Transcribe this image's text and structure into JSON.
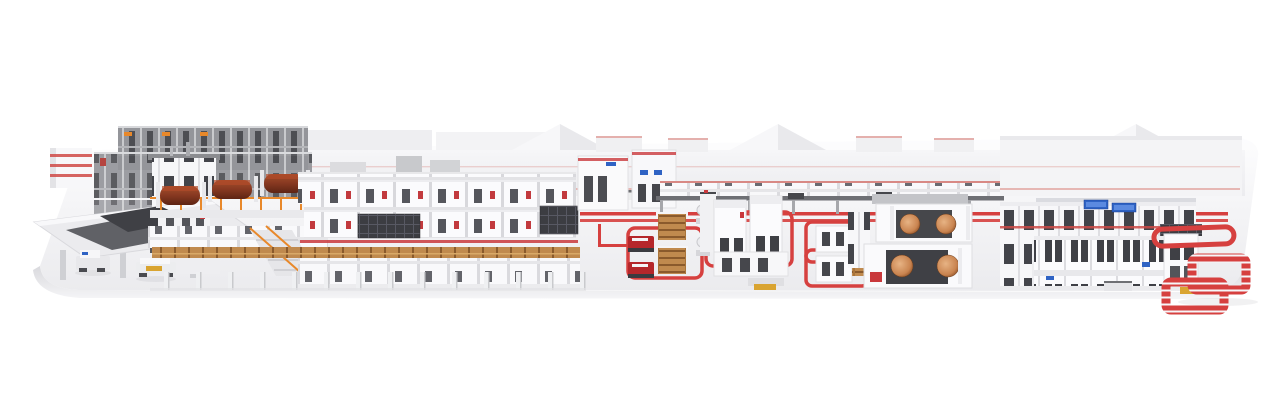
{
  "scene": {
    "kind": "3d-render-of-corrugated-board-production-line",
    "visible_text": []
  },
  "colors": {
    "page_bg": "#ffffff",
    "platform_top": "#fdfdfe",
    "platform_bottom": "#ebebee",
    "bevel_top": "#d9d9dd",
    "bevel_bottom": "#f5f5f7",
    "accent_red": "#c9383c",
    "loop_red": "#d6403f",
    "trim_red_faint": "#e4b0ad",
    "machine_white": "#fbfbfd",
    "slot_dark": "#3f4045",
    "rack_gray": "#94959a",
    "wood": "#c08a4e",
    "orange_rail": "#e8882a",
    "screen_blue": "#2f63c4",
    "vehicle_red": "#b5272b",
    "pallet_yellow": "#d9a431",
    "copper_roll": "#c98450",
    "paper_roll": "#7e3a22"
  },
  "components": [
    "platform",
    "background-buildings",
    "roll-storage-racks",
    "roll-splicing-station",
    "automated-guided-vehicles",
    "corrugator-wet-end",
    "corrugator-bridge",
    "dry-end-cabinets",
    "overhead-conveyor",
    "stacking-palletizing-cluster",
    "winder-cluster",
    "converting-line",
    "red-floor-conveyor-loops",
    "pallet-stacks",
    "shuttle-vehicles"
  ]
}
